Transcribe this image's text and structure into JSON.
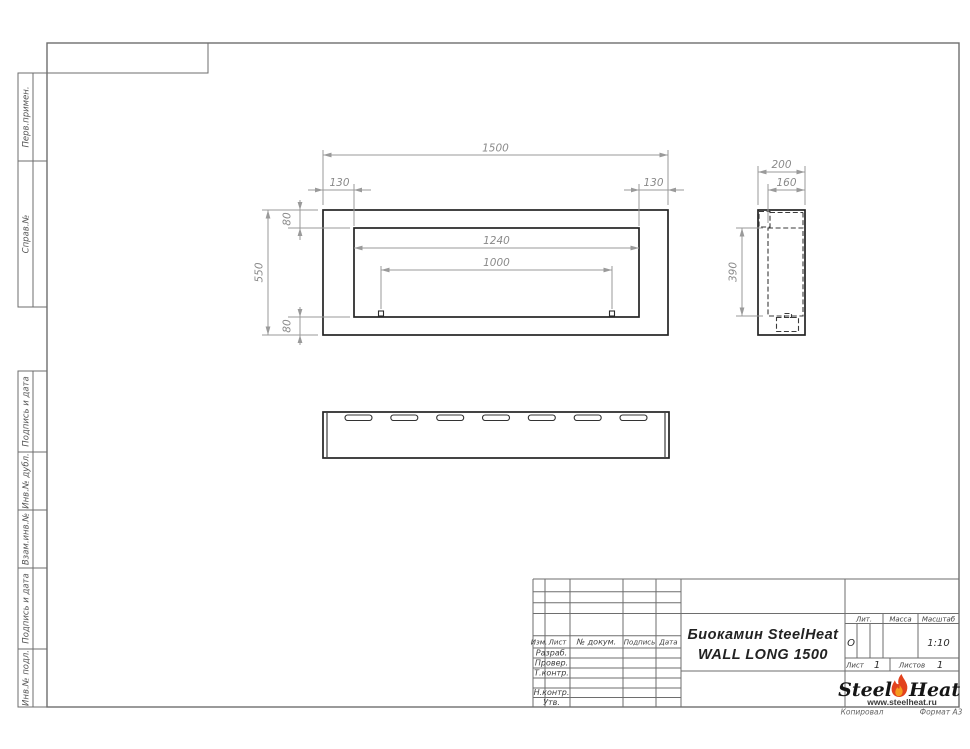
{
  "margin": {
    "labels": [
      "Перв.примен.",
      "Справ.№",
      "Подпись и дата",
      "Инв.№ дубл.",
      "Взам.инв.№",
      "Подпись и дата",
      "Инв.№ подл."
    ]
  },
  "dims": {
    "front_width": "1500",
    "edge_left": "130",
    "edge_right": "130",
    "top_offset": "80",
    "front_height": "550",
    "opening_width": "1240",
    "burner_width": "1000",
    "bottom_offset": "80",
    "side_depth": "200",
    "side_inner_depth": "160",
    "side_inner_height": "390"
  },
  "title_block": {
    "product_line1": "Биокамин SteelHeat",
    "product_line2": "WALL LONG 1500",
    "col_izm": "Изм.",
    "col_list": "Лист",
    "col_doc": "№ докум.",
    "col_sign": "Подпись",
    "col_date": "Дата",
    "row_developed": "Разраб.",
    "row_checked": "Провер.",
    "row_tcontrol": "Т.контр.",
    "row_ncontrol": "Н.контр.",
    "row_approved": "Утв.",
    "lit_label": "Лит.",
    "lit_value": "О",
    "mass_label": "Масса",
    "scale_label": "Масштаб",
    "scale_value": "1:10",
    "sheet_label": "Лист",
    "sheet_value": "1",
    "sheets_label": "Листов",
    "sheets_value": "1",
    "logo_steel": "Steel",
    "logo_heat": "Heat",
    "logo_site": "www.steelheat.ru"
  },
  "footer": {
    "copied": "Копировал",
    "format": "Формат А3"
  },
  "colors": {
    "flame_outer": "#e2421d",
    "flame_inner": "#f59b1e",
    "visible_edge": "#232323",
    "dimension": "#9a9a9a",
    "table_line": "#6e6e6e"
  }
}
